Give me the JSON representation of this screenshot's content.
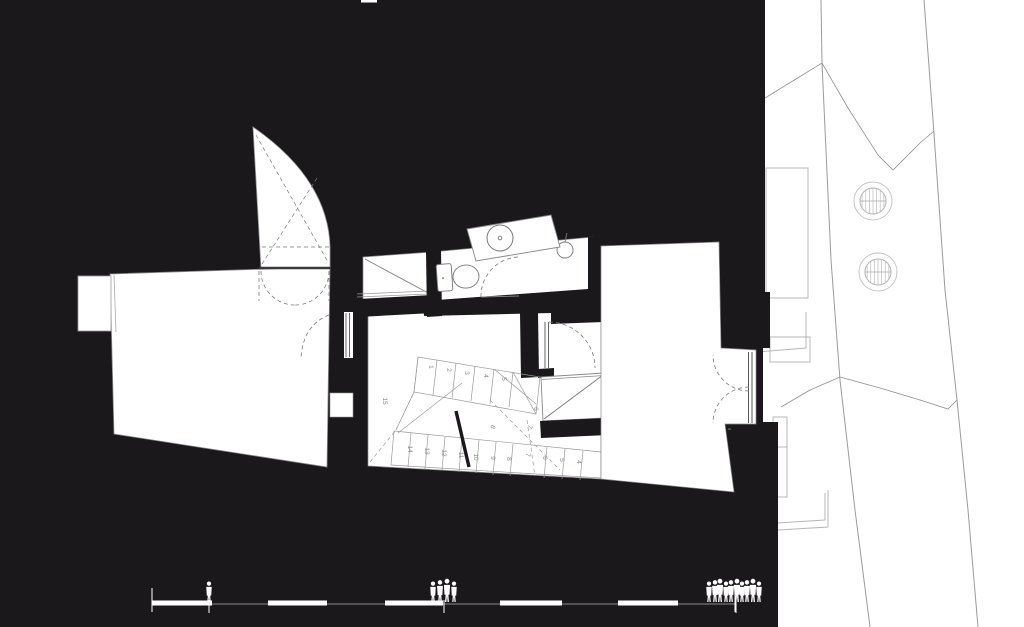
{
  "drawing": {
    "type": "architectural ground-floor plan, figure-ground style (black poché)",
    "colors": {
      "ink_black": "#1b181c",
      "paper_white": "#ffffff",
      "wall_dark": "#3a3a3a",
      "line_gray": "#8a8a8a",
      "light_gray": "#b7b7b7",
      "dash_gray": "#7a7a7a"
    }
  },
  "stair": {
    "tread_numbers": [
      {
        "label": "15",
        "x": 383,
        "y": 401,
        "rot": 90
      },
      {
        "label": "1",
        "x": 429,
        "y": 367,
        "rot": 90
      },
      {
        "label": "2",
        "x": 447,
        "y": 370,
        "rot": 90
      },
      {
        "label": "3",
        "x": 465,
        "y": 373,
        "rot": 90
      },
      {
        "label": "4",
        "x": 484,
        "y": 376,
        "rot": 90
      },
      {
        "label": "5",
        "x": 502,
        "y": 379,
        "rot": 90
      },
      {
        "label": "6",
        "x": 534,
        "y": 409,
        "rot": 90
      },
      {
        "label": "7",
        "x": 528,
        "y": 426,
        "rot": 115
      },
      {
        "label": "8",
        "x": 491,
        "y": 426,
        "rot": 115
      },
      {
        "label": "14",
        "x": 408,
        "y": 449,
        "rot": 90
      },
      {
        "label": "13",
        "x": 425,
        "y": 451,
        "rot": 90
      },
      {
        "label": "12",
        "x": 442,
        "y": 453,
        "rot": 90
      },
      {
        "label": "11",
        "x": 459,
        "y": 455,
        "rot": 90
      },
      {
        "label": "10",
        "x": 474,
        "y": 457,
        "rot": 90
      },
      {
        "label": "9",
        "x": 491,
        "y": 458,
        "rot": 90
      },
      {
        "label": "8",
        "x": 507,
        "y": 459,
        "rot": 90
      },
      {
        "label": "7",
        "x": 526,
        "y": 455,
        "rot": 90
      },
      {
        "label": "6",
        "x": 543,
        "y": 458,
        "rot": 90
      },
      {
        "label": "5",
        "x": 560,
        "y": 460,
        "rot": 90
      },
      {
        "label": "4",
        "x": 577,
        "y": 462,
        "rot": 90
      },
      {
        "label": "2",
        "x": 612,
        "y": 462,
        "rot": 90
      },
      {
        "label": "1",
        "x": 629,
        "y": 464,
        "rot": 90
      }
    ]
  },
  "scale_bar": {
    "baseline": {
      "x1": 152,
      "x2": 735,
      "y": 604
    },
    "segments": [
      {
        "x": 152,
        "w": 60
      },
      {
        "x": 268,
        "w": 59
      },
      {
        "x": 385,
        "w": 58
      },
      {
        "x": 500,
        "w": 62
      },
      {
        "x": 618,
        "w": 60
      }
    ],
    "end_ticks": [
      152,
      735
    ],
    "figure_groups": [
      {
        "x": 209,
        "count": 1
      },
      {
        "x": 444,
        "count": 4
      },
      {
        "x": 736,
        "count": 10
      }
    ]
  },
  "site": {
    "trees": [
      {
        "cx": 873,
        "cy": 201,
        "r_outer": 19,
        "r_inner": 13
      },
      {
        "cx": 878,
        "cy": 272,
        "r_outer": 19,
        "r_inner": 13
      }
    ]
  }
}
